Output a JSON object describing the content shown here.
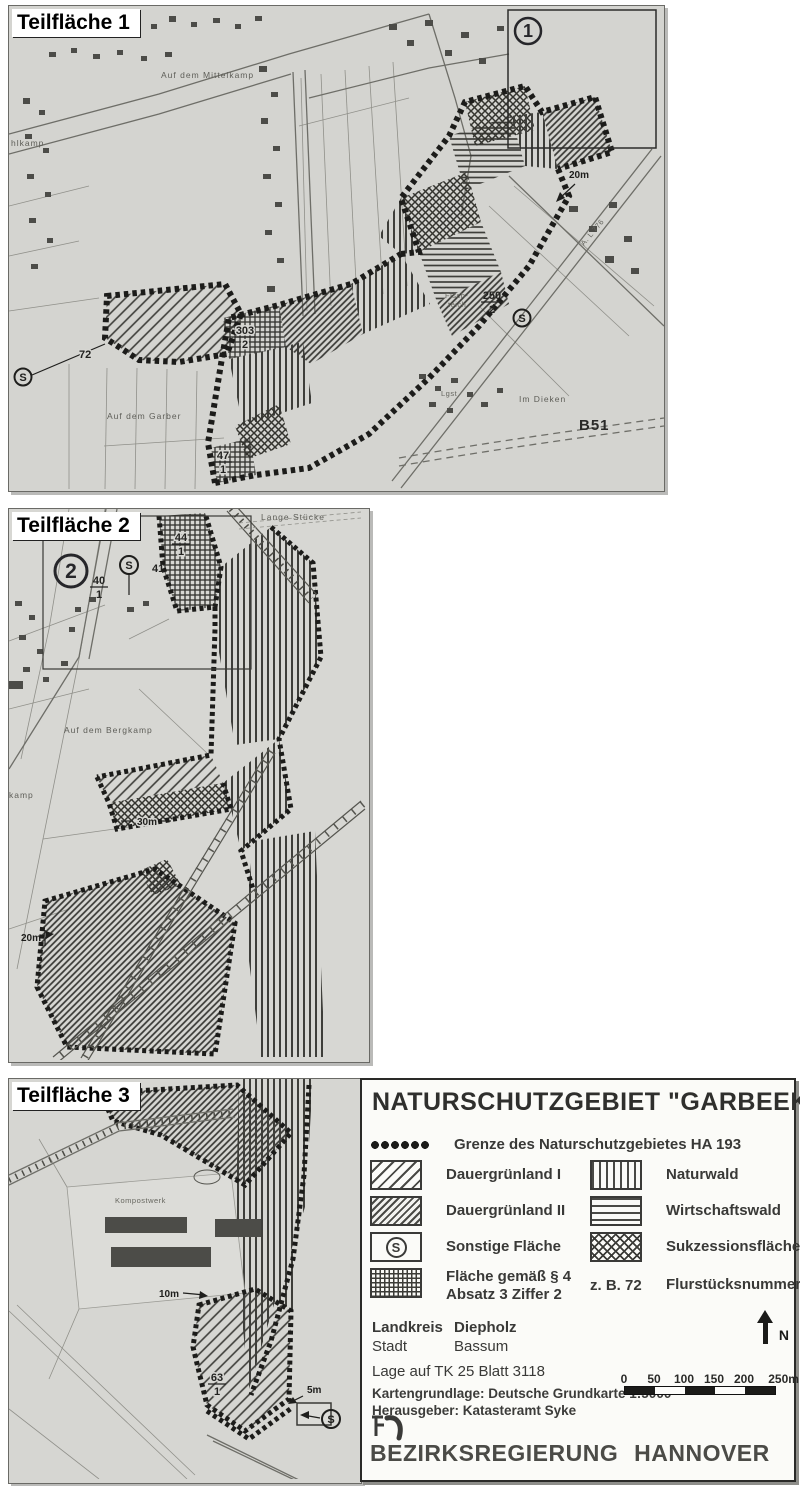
{
  "colors": {
    "paper": "#d6d6d2",
    "ink": "#3e3e3a",
    "boundary": "#1c1c1a",
    "legend_bg": "#fbfbf8",
    "text_dark": "#2f2f2d"
  },
  "map1": {
    "panel_label": "Teilfläche 1",
    "inset_number": "1",
    "field_names": {
      "mittelkamp": "Auf dem Mittelkamp",
      "garber": "Auf dem Garber",
      "im_dieken": "Im Dieken",
      "hlkamp": "hlkamp"
    },
    "road_labels": {
      "b51": "B51",
      "l776": "A. L 776"
    },
    "annotations": {
      "width_20m": "20m",
      "lgst": "Lgst",
      "fischteich_line1": "Fisch-",
      "fischteich_line2": "teich"
    },
    "parcels": {
      "p72": "72",
      "p250_num": "250",
      "p250_den": "2",
      "p303_num": "303",
      "p303_den": "2",
      "p47_num": "47",
      "p47_den": "1"
    },
    "s_symbol": "S"
  },
  "map2": {
    "panel_label": "Teilfläche 2",
    "inset_number": "2",
    "field_names": {
      "bergkamp": "Auf dem Bergkamp",
      "kamp": "kamp",
      "lange_stuecke": "Lange Stücke"
    },
    "annotations": {
      "width_30m": "30m",
      "width_20m": "20m"
    },
    "parcels": {
      "p41": "41",
      "p40_num": "40",
      "p40_den": "1",
      "p44_num": "44",
      "p44_den": "1"
    },
    "s_symbol": "S"
  },
  "map3": {
    "panel_label": "Teilfläche 3",
    "field_names": {
      "kompostwerk": "Kompostwerk"
    },
    "annotations": {
      "width_10m": "10m",
      "width_5m": "5m"
    },
    "parcels": {
      "p63_num": "63",
      "p63_den": "1"
    },
    "s_symbol": "S"
  },
  "legend": {
    "title": "NATURSCHUTZGEBIET \"GARBEEKE\"",
    "s_symbol": "S",
    "items_left": [
      {
        "swatch": "boundary-dots",
        "label": "Grenze des Naturschutzgebietes HA 193"
      },
      {
        "swatch": "diagonal-hatch-light",
        "label": "Dauergrünland I"
      },
      {
        "swatch": "diagonal-hatch-dense",
        "label": "Dauergrünland II"
      },
      {
        "swatch": "s-circle-box",
        "label": "Sonstige Fläche"
      },
      {
        "swatch": "grid-hatch",
        "label": "Fläche gemäß § 4",
        "label2": "Absatz 3 Ziffer 2"
      }
    ],
    "items_right": [
      {
        "swatch": "vertical-lines",
        "label": "Naturwald"
      },
      {
        "swatch": "horizontal-lines",
        "label": "Wirtschaftswald"
      },
      {
        "swatch": "cross-hatch",
        "label": "Sukzessionsfläche"
      },
      {
        "swatch": "text-example",
        "example": "z. B. 72",
        "label": "Flurstücksnummer"
      }
    ],
    "admin": {
      "landkreis_label": "Landkreis",
      "landkreis_value": "Diepholz",
      "stadt_label": "Stadt",
      "stadt_value": "Bassum"
    },
    "sheet": "Lage auf TK 25 Blatt 3118",
    "source1": "Kartengrundlage: Deutsche Grundkarte 1:5000",
    "source2": "Herausgeber: Katasteramt Syke",
    "north": "N",
    "scale_labels": [
      "0",
      "50",
      "100",
      "150",
      "200",
      "250m"
    ],
    "publisher": "BEZIRKSREGIERUNG HANNOVER"
  }
}
